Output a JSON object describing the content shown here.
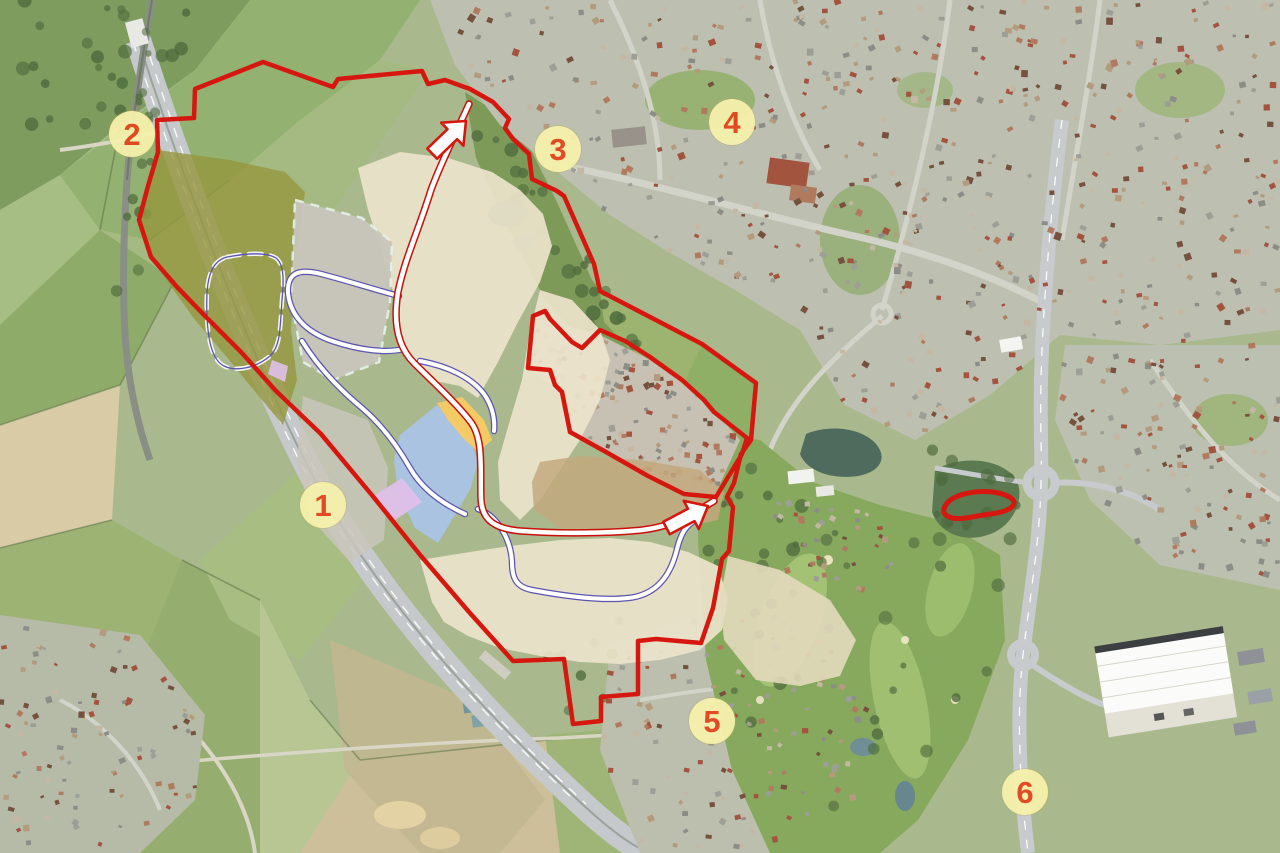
{
  "map": {
    "description_name": "aerial-masterplan-map",
    "markers": [
      {
        "id": "1",
        "label": "1",
        "x": 323,
        "y": 505
      },
      {
        "id": "2",
        "label": "2",
        "x": 132,
        "y": 134
      },
      {
        "id": "3",
        "label": "3",
        "x": 558,
        "y": 149
      },
      {
        "id": "4",
        "label": "4",
        "x": 732,
        "y": 122
      },
      {
        "id": "5",
        "label": "5",
        "x": 712,
        "y": 721
      },
      {
        "id": "6",
        "label": "6",
        "x": 1025,
        "y": 792
      }
    ],
    "marker_style": {
      "bg": "#f6f1ac",
      "text": "#e2461d"
    },
    "colors": {
      "boundary": "#d6170f",
      "olive": "#95973e",
      "cream": "#ece4cb",
      "grey": "#c9c5bc",
      "blue": "#a9c3e5",
      "orange": "#f8ca63",
      "purple": "#dfc0e9",
      "road_red": "#c8100b",
      "road_blue": "#5b55b0",
      "road_fill": "#ffffff"
    },
    "arrows": [
      {
        "name": "north-access-arrow",
        "tip_x": 466,
        "tip_y": 121,
        "angle": 136
      },
      {
        "name": "east-access-arrow",
        "tip_x": 708,
        "tip_y": 506,
        "angle": 152
      }
    ]
  }
}
